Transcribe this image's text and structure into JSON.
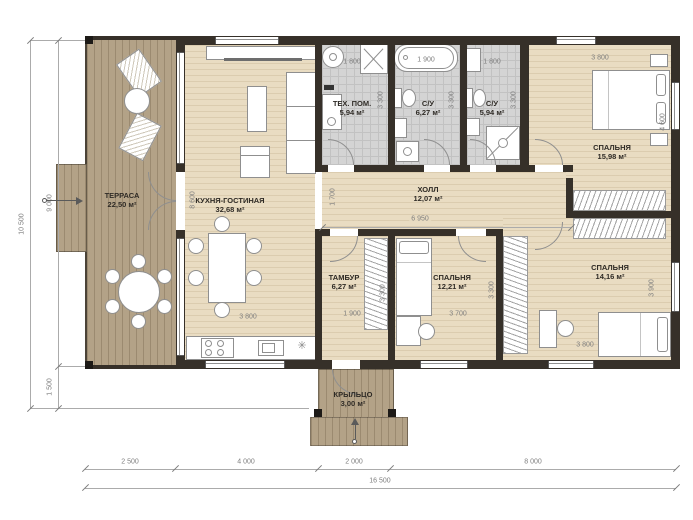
{
  "colors": {
    "wall": "#363029",
    "wood": "#e9dcc2",
    "terrace": "#b3a287",
    "tile": "#d4d4d4",
    "ink": "#2f2b26",
    "dim": "#7e7e7e"
  },
  "rooms": {
    "terrace": {
      "name": "ТЕРРАСА",
      "area": "22,50 м²"
    },
    "kitchen_living": {
      "name": "КУХНЯ-ГОСТИНАЯ",
      "area": "32,68 м²"
    },
    "tech": {
      "name": "ТЕХ. ПОМ.",
      "area": "5,94 м²"
    },
    "bath_big": {
      "name": "С/У",
      "area": "6,27 м²"
    },
    "bath_small": {
      "name": "С/У",
      "area": "5,94 м²"
    },
    "bedroom_master": {
      "name": "СПАЛЬНЯ",
      "area": "15,98 м²"
    },
    "hall": {
      "name": "ХОЛЛ",
      "area": "12,07 м²"
    },
    "tambour": {
      "name": "ТАМБУР",
      "area": "6,27 м²"
    },
    "bedroom_small": {
      "name": "СПАЛЬНЯ",
      "area": "12,21 м²"
    },
    "bedroom_mid": {
      "name": "СПАЛЬНЯ",
      "area": "14,16 м²"
    },
    "porch": {
      "name": "КРЫЛЬЦО",
      "area": "3,00 м²"
    }
  },
  "dims": {
    "left_total": "10 500",
    "left_main": "9 000",
    "left_bottom": "1 500",
    "bottom_1": "2 500",
    "bottom_2": "4 000",
    "bottom_3": "2 000",
    "bottom_4": "8 000",
    "bottom_total": "16 500",
    "tech_w": "1 800",
    "bath_big_w": "1 900",
    "bath_small_w": "1 800",
    "master_w": "3 800",
    "tech_d": "3 300",
    "bath_big_d": "3 300",
    "bath_small_d": "3 300",
    "kitchen_h": "8 600",
    "kitchen_w": "3 800",
    "hall_d": "1 700",
    "hall_w": "6 950",
    "master_d": "4 600",
    "tambour_w": "1 900",
    "tambour_d": "3 300",
    "bedroom_small_w": "3 700",
    "bedroom_small_d": "3 300",
    "bedroom_mid_w": "3 800",
    "bedroom_mid_d": "3 900"
  }
}
